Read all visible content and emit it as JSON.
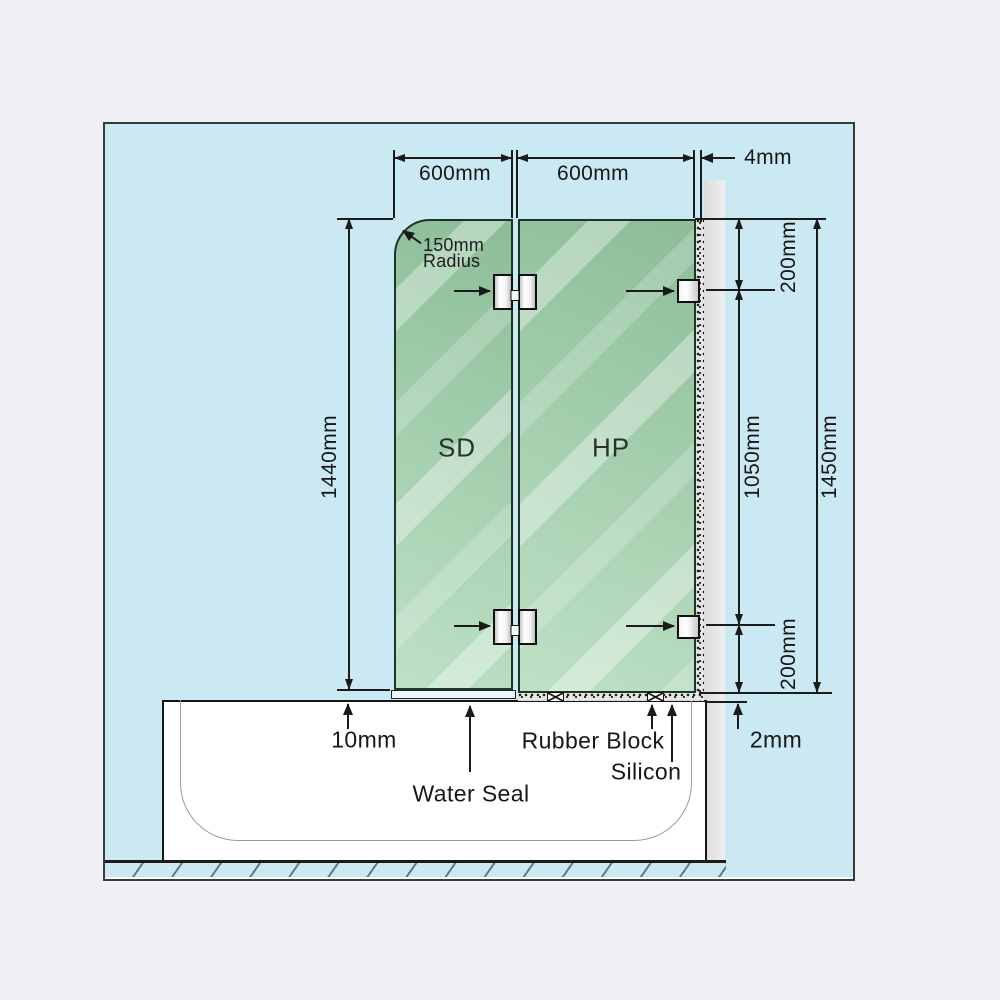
{
  "diagram": {
    "type": "shower-screen-installation-diagram",
    "panels": {
      "shower_door_label": "SD",
      "hinge_panel_label": "HP"
    },
    "dimensions": {
      "sd_width": "600mm",
      "hp_width": "600mm",
      "wall_gap": "4mm",
      "radius_value": "150mm",
      "radius_word": "Radius",
      "sd_height": "1440mm",
      "top_bracket_offset": "200mm",
      "bracket_spacing": "1050mm",
      "bottom_bracket_offset": "200mm",
      "hp_height": "1450mm",
      "bottom_gap": "10mm",
      "tub_gap": "2mm"
    },
    "annotations": {
      "water_seal": "Water Seal",
      "rubber_block": "Rubber Block",
      "silicon": "Silicon"
    },
    "colors": {
      "page_background": "#eef0f4",
      "diagram_background": "#cbe9f2",
      "glass_green": "#a8d7b2",
      "wall_gray": "#e3e3e3",
      "line_ink": "#1b1b1b"
    }
  }
}
